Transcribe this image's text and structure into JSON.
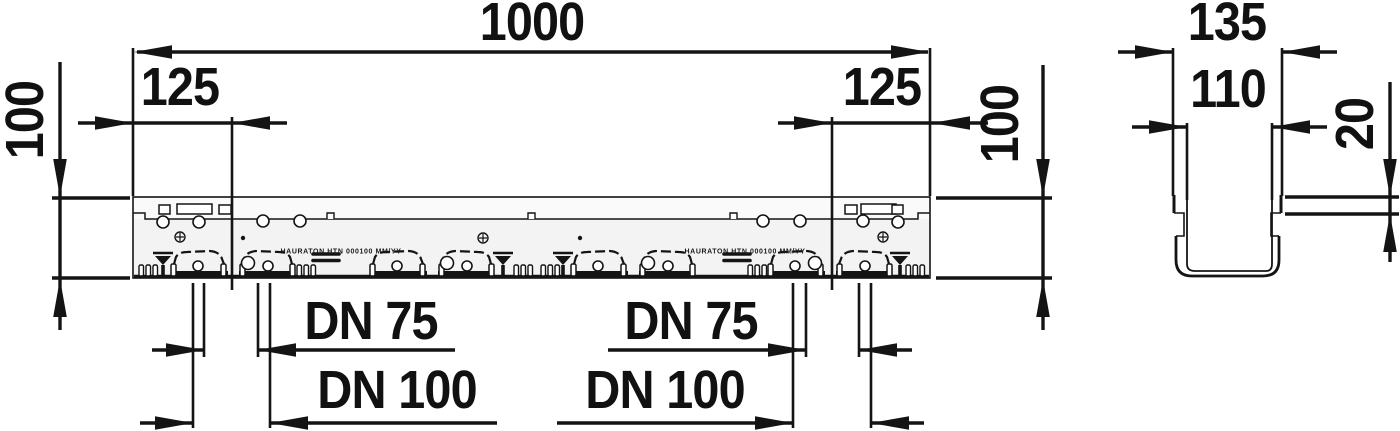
{
  "plan_view": {
    "length_label": "1000",
    "left_end_offset_label": "125",
    "right_end_offset_label": "125",
    "height_label_left": "100",
    "height_label_right": "100",
    "molded_marking_left": "HAURATON HTN 000100 MM/YY",
    "molded_marking_right": "HAURATON HTN 000100 MM/YY",
    "outlets_left": {
      "dn75_label": "DN 75",
      "dn100_label": "DN 100"
    },
    "outlets_right": {
      "dn75_label": "DN 75",
      "dn100_label": "DN 100"
    }
  },
  "section_view": {
    "outer_width_label": "135",
    "inner_width_label": "110",
    "lip_depth_label": "20"
  },
  "colors": {
    "line": "#141414",
    "background": "#ffffff",
    "body_fill": "#f3f3f3"
  }
}
